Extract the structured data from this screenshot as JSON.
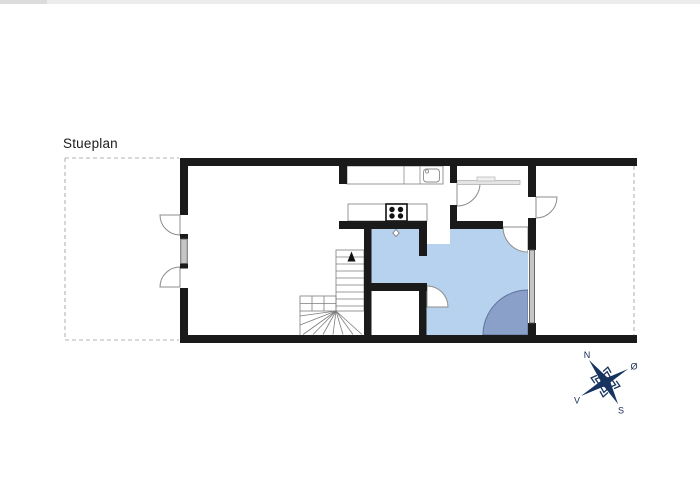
{
  "page": {
    "title": "Stueplan",
    "background": "#ffffff"
  },
  "compass": {
    "north_label": "N",
    "east_label": "Ø",
    "south_label": "S",
    "west_label": "V"
  },
  "legend": {
    "fixtures": [
      "kitchen-sink",
      "stove",
      "kitchen-counter",
      "hall-bench",
      "stairs",
      "bathroom",
      "shower-corner",
      "window",
      "door"
    ]
  },
  "css_vars": {
    "--wall": "#1a1a1a",
    "--outline": "#8c8c8c",
    "--dash": "#b3b3b3",
    "--bath": "#b7d2ee",
    "--shower": "#8ba0c8",
    "--showerline": "#5d7199",
    "--window": "#c6c6c6",
    "--compass": "#17335f",
    "--band": "#ececec"
  }
}
